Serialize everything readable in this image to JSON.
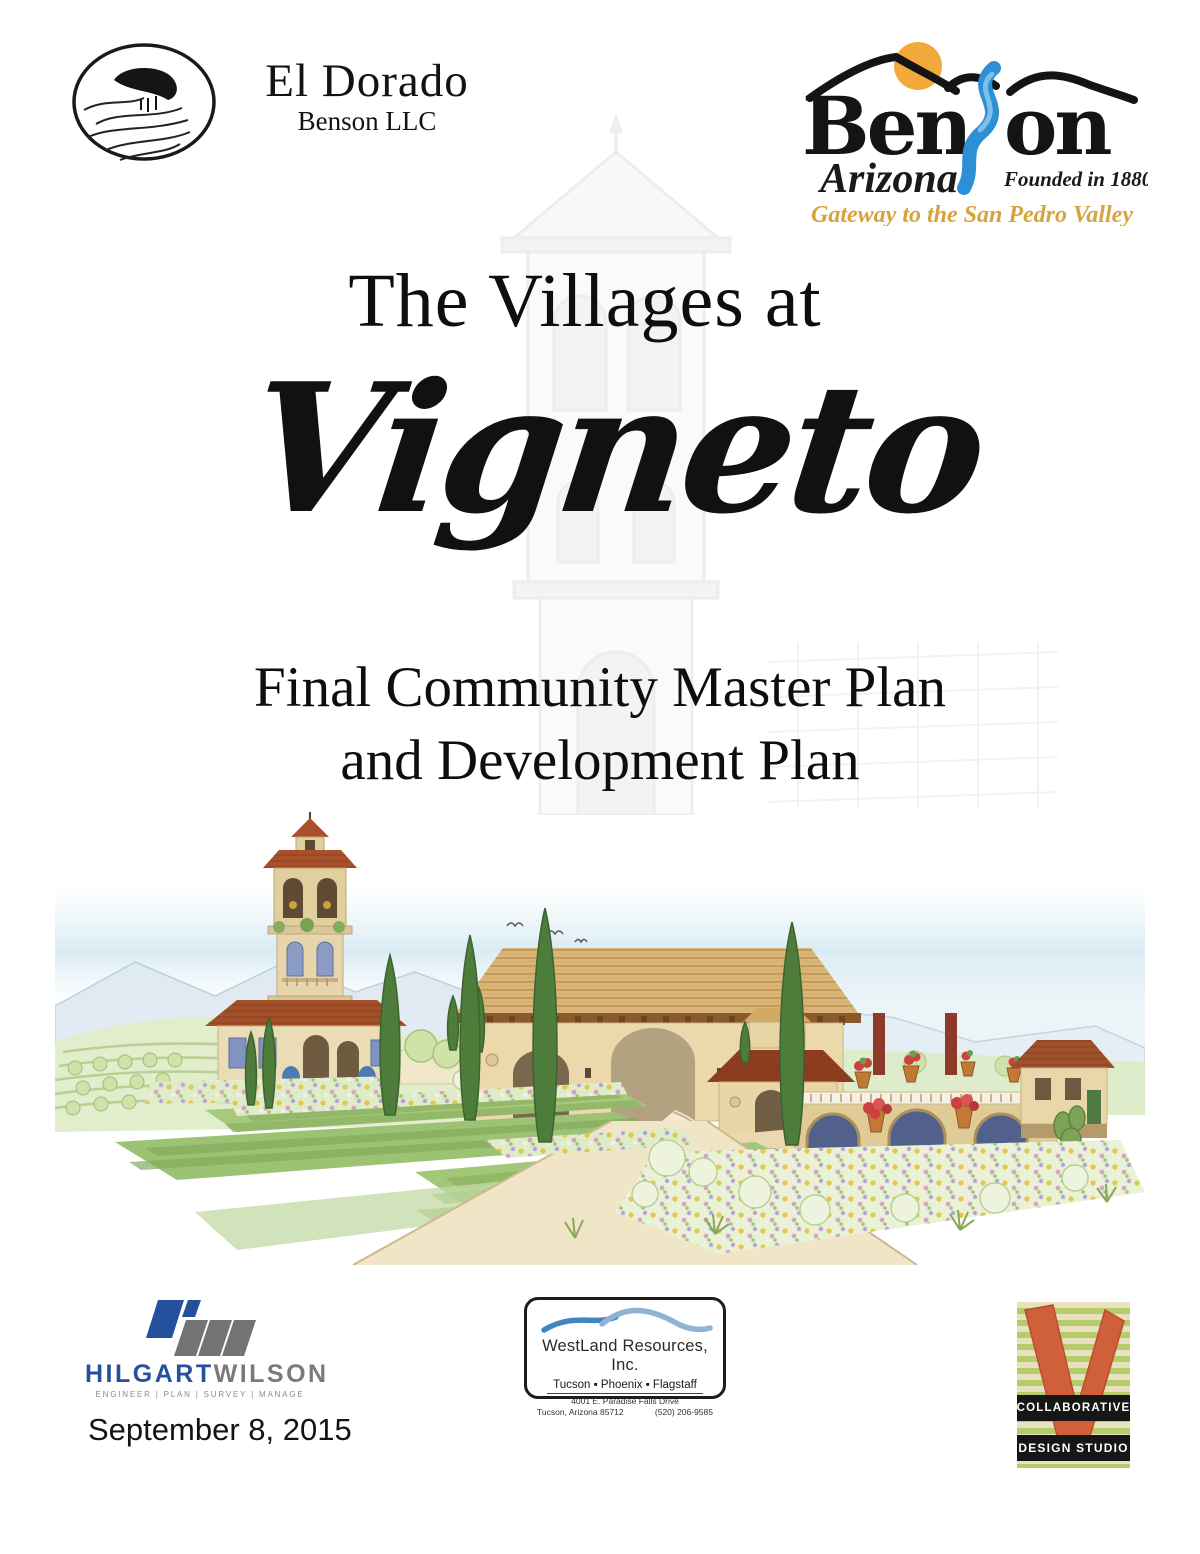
{
  "page": {
    "title_document": "The Villages at Vigneto cover page"
  },
  "header": {
    "eldorado": {
      "title": "El Dorado",
      "subtitle": "Benson LLC"
    },
    "benson": {
      "word_start": "Ben",
      "word_end": "on",
      "state": "Arizona",
      "founded": "Founded in 1880",
      "tagline": "Gateway to the San Pedro Valley",
      "colors": {
        "sun": "#f2a93b",
        "river": "#2d8fd5",
        "tagline_gold": "#d6a33c"
      }
    }
  },
  "title_block": {
    "pre_title": "The Villages at",
    "name": "Vigneto",
    "subtitle_line1": "Final Community Master Plan",
    "subtitle_line2": "and Development Plan"
  },
  "illustration": {
    "description": "watercolor rendering of a Tuscan-style village entry: bell tower villa, tiled gateway arches, stone bridge over a stream, cypress trees, vineyard hills and flower beds"
  },
  "footer": {
    "hilgartwilson": {
      "name_primary": "HILGART",
      "name_secondary": "WILSON",
      "tagline": "ENGINEER  |  PLAN  |  SURVEY  |  MANAGE",
      "colors": {
        "primary": "#24509e",
        "secondary": "#7a7a7a"
      }
    },
    "date": "September 8, 2015",
    "westland": {
      "company": "WestLand Resources, Inc.",
      "cities_line": "Tucson  ▪  Phoenix  ▪  Flagstaff",
      "address_line1": "4001 E. Paradise Falls Drive",
      "address_city": "Tucson, Arizona 85712",
      "phone": "(520) 206-9585"
    },
    "collaborative": {
      "line1": "COLLABORATIVE",
      "line2": "DESIGN STUDIO",
      "colors": {
        "check": "#d0603a",
        "stripe_green": "#b6cc6a",
        "stripe_tan": "#e7e1bf"
      }
    }
  }
}
